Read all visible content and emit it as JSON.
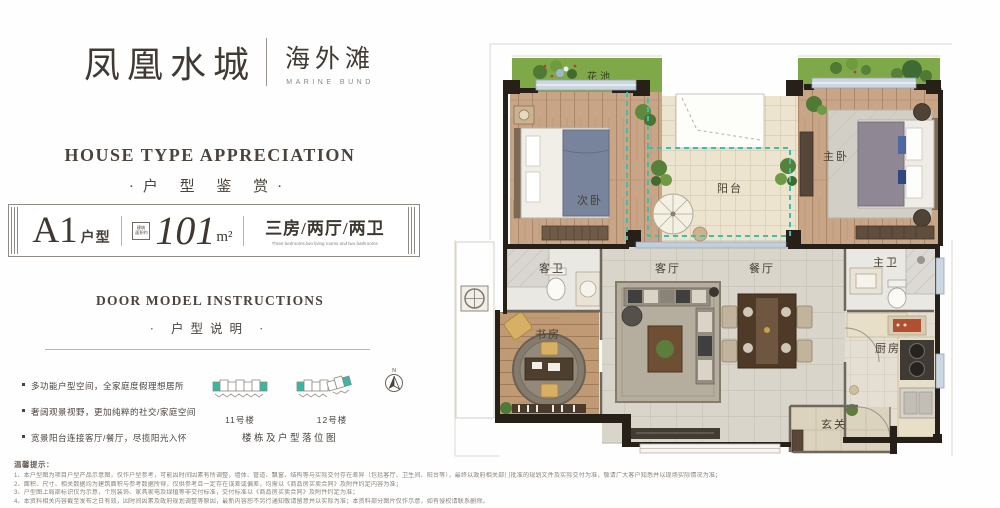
{
  "brand": {
    "name_cn": "凤凰水城",
    "sub_cn": "海外滩",
    "sub_en": "MARINE BUND"
  },
  "section1": {
    "title_en": "HOUSE TYPE APPRECIATION",
    "title_cn": "·户 型 鉴 赏·"
  },
  "banner": {
    "type_code": "A1",
    "type_suffix": "户型",
    "area_note_l1": "建筑",
    "area_note_l2": "面积约",
    "area_value": "101",
    "area_unit": "m²",
    "rooms_cn": "三房/两厅/两卫",
    "rooms_en": "Three bedrooms,two living rooms and two bathrooms"
  },
  "section2": {
    "title_en": "DOOR MODEL INSTRUCTIONS",
    "title_cn": "· 户型说明 ·"
  },
  "features": [
    "多功能户型空间，全家庭度假理想居所",
    "奢阔观景视野，更加纯粹的社交/家庭空间",
    "宽景阳台连接客厅/餐厅，尽揽阳光入怀"
  ],
  "buildings": {
    "b1": "11号楼",
    "b2": "12号楼",
    "caption": "楼栋及户型落位图",
    "compass": "N"
  },
  "disclaimer": {
    "title": "温馨提示：",
    "lines": [
      "1、本户型图为项目户型产品示意图，仅作户型参考，可能因时间因素有所调整，墙体、管道、飘窗、结构等与实际交付存在差异（包括客厅、卫生间、阳台等），最终以政府相关部门批准的规划文件及实际交付为准，敬请广大客户知悉并以现场实际情况为准；",
      "2、面积、尺寸、相关数据均为建筑面积与参考数据所得，仅供参考且一定存在误差或偏差，均需以《商品房买卖合同》及附件约定内容为准；",
      "3、户型图上局部标识仅为示意，个别装饰、家具家电及绿植等非交付标准，交付标准以《商品房买卖合同》及附件约定为准；",
      "4、本资料相关内容截至发布之日有效，因时间因素及政府规划调整等原因，最新内容恕不另行通知敬请留意并以实际为准；本资料部分图片仅作示意，如有侵权请联系删除。"
    ]
  },
  "floorplan": {
    "flower_bed": "花池",
    "second_bedroom": "次卧",
    "master_bedroom": "主卧",
    "balcony": "阳台",
    "guest_bath": "客卫",
    "living_room": "客厅",
    "dining_room": "餐厅",
    "master_bath": "主卫",
    "study": "书房",
    "kitchen": "厨房",
    "entry": "玄关"
  }
}
